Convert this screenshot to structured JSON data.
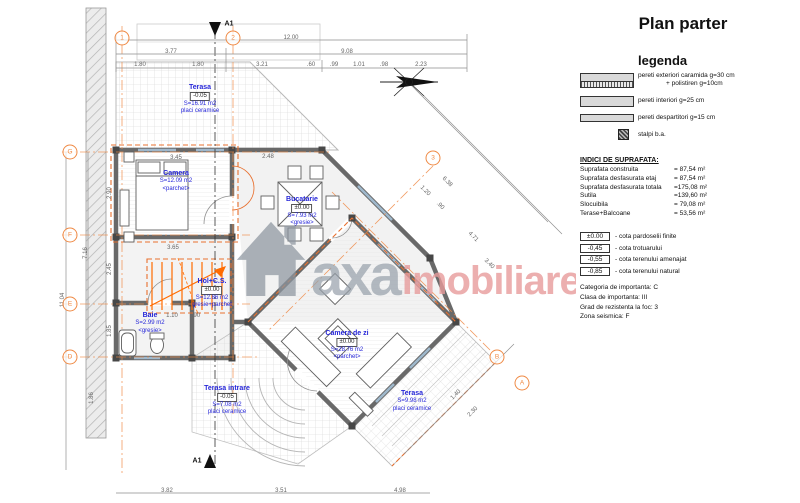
{
  "title": "Plan parter",
  "legend": {
    "heading": "legenda",
    "items": [
      {
        "label": "pereti exteriori caramida g=30 cm",
        "label2": "+ polistiren g=10cm",
        "swatch": "exterior-wall"
      },
      {
        "label": "pereti interiori g=25 cm",
        "swatch": "interior-wall"
      },
      {
        "label": "pereti despartitori g=15 cm",
        "swatch": "partition-wall"
      },
      {
        "label": "stalpi b.a.",
        "swatch": "concrete-column"
      }
    ]
  },
  "surface_indices": {
    "heading": "INDICI DE SUPRAFATA:",
    "rows": [
      {
        "label": "Suprafata construita",
        "value": "= 87,54 m²"
      },
      {
        "label": "Suprafata desfasurata etaj",
        "value": "= 87,54 m²"
      },
      {
        "label": "Suprafata desfasurata totala",
        "value": "=175,08 m²"
      },
      {
        "label": "Sutila",
        "value": "=139,60 m²"
      },
      {
        "label": "Slocuibila",
        "value": "= 79,08 m²"
      },
      {
        "label": "Terase+Balcoane",
        "value": "= 53,56 m²"
      }
    ]
  },
  "elevations": [
    {
      "value": "±0.00",
      "label": "- cota pardoselii finite"
    },
    {
      "value": "-0,45",
      "label": "- cota trotuarului"
    },
    {
      "value": "-0,55",
      "label": "- cota terenului amenajat"
    },
    {
      "value": "-0,85",
      "label": "- cota terenului natural"
    }
  ],
  "classification": [
    "Categoria de importanta: C",
    "Clasa de importanta: III",
    "Grad de rezistenta la foc: 3",
    "Zona seismica: F"
  ],
  "watermark": {
    "icon": "house-icon",
    "brand_gray": "axa",
    "brand_pink": "imobiliare"
  },
  "icons": {
    "north_arrow": "north-arrow-icon",
    "house": "house-icon"
  },
  "colors": {
    "axis_orange": "#EF8A45",
    "stair_orange": "#FF6B00",
    "room_label_blue": "#2525D8",
    "watermark_gray": "#99A2AC",
    "watermark_pink": "#E89C9C"
  },
  "plan": {
    "rooms": [
      {
        "name": "Terasa",
        "cota": "-0.05",
        "area": "S=16.91 m2",
        "finish": "placi ceramice",
        "x": 200,
        "y": 84
      },
      {
        "name": "Camera",
        "area": "S=12.09 m2",
        "finish": "<parchet>",
        "x": 176,
        "y": 170
      },
      {
        "name": "Bucatarie",
        "cota": "±0.00",
        "area": "S=7.93 m2",
        "finish": "<gresie>",
        "x": 302,
        "y": 196
      },
      {
        "name": "Hol+C.S.",
        "cota": "±0.00",
        "area": "S=12.86 m2",
        "finish": "gresie+parchet",
        "x": 212,
        "y": 278
      },
      {
        "name": "Baie",
        "area": "S=2.99 m2",
        "finish": "<gresie>",
        "x": 150,
        "y": 312
      },
      {
        "name": "Camera de zi",
        "cota": "±0.00",
        "area": "S=28.76 m2",
        "finish": "<parchet>",
        "x": 347,
        "y": 330
      },
      {
        "name": "Terasa",
        "area": "S=9.98 m2",
        "finish": "placi ceramice",
        "x": 412,
        "y": 390
      },
      {
        "name": "Terasa intrare",
        "cota": "-0.05",
        "area": "S=7.08 m2",
        "finish": "placi ceramice",
        "x": 227,
        "y": 385
      }
    ],
    "dims": [
      {
        "t": "12.00",
        "x": 291,
        "y": 38
      },
      {
        "t": "3.77",
        "x": 171,
        "y": 52
      },
      {
        "t": "9.08",
        "x": 347,
        "y": 52
      },
      {
        "t": "1.80",
        "x": 140,
        "y": 65
      },
      {
        "t": "1.80",
        "x": 198,
        "y": 65
      },
      {
        "t": "3.21",
        "x": 262,
        "y": 65
      },
      {
        "t": ".60",
        "x": 311,
        "y": 65
      },
      {
        "t": ".99",
        "x": 334,
        "y": 65
      },
      {
        "t": "1.01",
        "x": 359,
        "y": 65
      },
      {
        "t": ".98",
        "x": 384,
        "y": 65
      },
      {
        "t": "2.23",
        "x": 421,
        "y": 65
      },
      {
        "t": "11.04",
        "x": 63,
        "y": 300,
        "r": -90
      },
      {
        "t": "7.16",
        "x": 86,
        "y": 253,
        "r": -90
      },
      {
        "t": "1.86",
        "x": 92,
        "y": 398,
        "r": -90
      },
      {
        "t": "2.90",
        "x": 110,
        "y": 193,
        "r": -90
      },
      {
        "t": "2.45",
        "x": 110,
        "y": 269,
        "r": -90
      },
      {
        "t": "1.85",
        "x": 110,
        "y": 331,
        "r": -90
      },
      {
        "t": "3.82",
        "x": 167,
        "y": 491
      },
      {
        "t": "3.51",
        "x": 281,
        "y": 491
      },
      {
        "t": "4.98",
        "x": 400,
        "y": 491
      },
      {
        "t": "6.38",
        "x": 447,
        "y": 182,
        "r": 45
      },
      {
        "t": "1.20",
        "x": 425,
        "y": 191,
        "r": 45
      },
      {
        "t": ".90",
        "x": 440,
        "y": 206,
        "r": 45
      },
      {
        "t": "4.71",
        "x": 473,
        "y": 237,
        "r": 45
      },
      {
        "t": "3.40",
        "x": 489,
        "y": 264,
        "r": 45
      },
      {
        "t": "1.40",
        "x": 456,
        "y": 395,
        "r": -45
      },
      {
        "t": "2.30",
        "x": 473,
        "y": 412,
        "r": -45
      },
      {
        "t": "3.65",
        "x": 173,
        "y": 248
      },
      {
        "t": "3.45",
        "x": 176,
        "y": 158
      },
      {
        "t": "2.48",
        "x": 268,
        "y": 157
      },
      {
        "t": "1.10",
        "x": 172,
        "y": 316
      },
      {
        "t": ".90",
        "x": 196,
        "y": 316
      }
    ],
    "axes": [
      {
        "label": "1",
        "x": 122,
        "y": 38
      },
      {
        "label": "2",
        "x": 233,
        "y": 38
      },
      {
        "label": "3",
        "x": 433,
        "y": 158
      },
      {
        "label": "G",
        "x": 70,
        "y": 152
      },
      {
        "label": "F",
        "x": 70,
        "y": 235
      },
      {
        "label": "E",
        "x": 70,
        "y": 304
      },
      {
        "label": "D",
        "x": 70,
        "y": 357
      },
      {
        "label": "B",
        "x": 497,
        "y": 357
      },
      {
        "label": "A",
        "x": 522,
        "y": 383
      }
    ],
    "sections": [
      {
        "label": "A1",
        "x": 229,
        "y": 24
      },
      {
        "label": "A1",
        "x": 197,
        "y": 461
      }
    ]
  }
}
